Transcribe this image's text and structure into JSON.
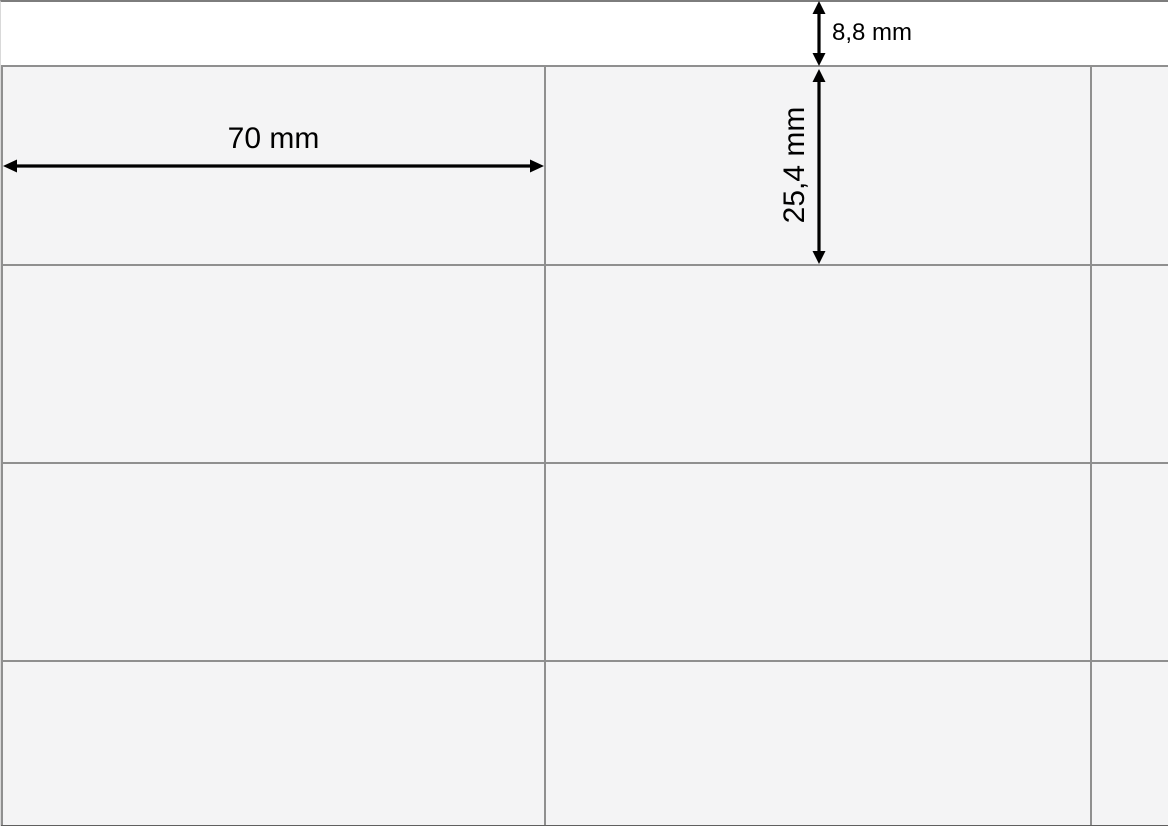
{
  "page": {
    "background": "#ffffff",
    "edge_line_color": "#7d7d7d",
    "bottom_edge_color": "#5f5f5f"
  },
  "sheet": {
    "cell_fill": "#f4f4f5",
    "grid_line_color": "#8f8f8f",
    "columns": 3,
    "rows": 4
  },
  "annotations": {
    "color": "#000000",
    "top_margin": "8,8 mm",
    "label_width": "70 mm",
    "label_height": "25,4 mm"
  }
}
